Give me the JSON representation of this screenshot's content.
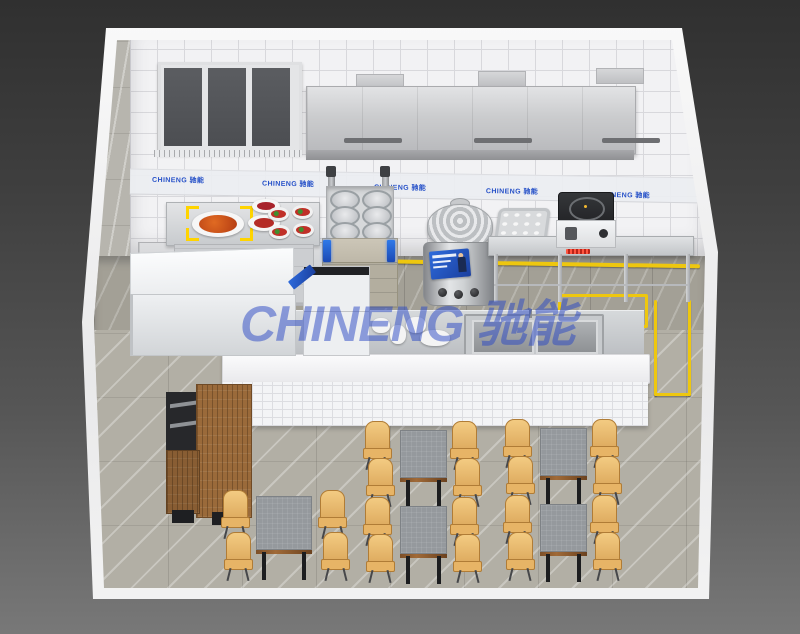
{
  "branding": {
    "watermark": "CHINENG 驰能",
    "wall_logo": "CHINENG 驰能",
    "watermark_color": "#2746c3",
    "logo_blue": "#2550c8"
  },
  "colors": {
    "safety_yellow": "#eec70f",
    "stainless_steel": "#c9ccd0",
    "wall_tile": "#f2f2f4",
    "kitchen_floor": "#a3a096",
    "dining_floor": "#b2afa5",
    "wood_cabinet": "#9a6a3a",
    "chair_wood": "#e7b96f",
    "table_top": "#95999d",
    "background_dark": "#3a3a3a"
  },
  "scene": {
    "description": "3D isometric render of a commercial kitchen with dining area",
    "equipment": [
      "window",
      "exhaust-hood",
      "prep-table-with-dishes",
      "wall-cabinets",
      "double-basket-noodle-cooker",
      "soup-boiler",
      "steam-tray",
      "work-table",
      "induction-cooker",
      "chest-unit",
      "side-cabinet",
      "pass-counter",
      "double-sink",
      "wood-service-station",
      "dining-tables",
      "chairs"
    ],
    "dining_tables": 5,
    "chairs_per_table": 4,
    "wall_logo_positions": [
      {
        "x": 152,
        "y": 5
      },
      {
        "x": 262,
        "y": 7
      },
      {
        "x": 374,
        "y": 9
      },
      {
        "x": 486,
        "y": 11
      },
      {
        "x": 598,
        "y": 13
      }
    ],
    "furniture": {
      "tables": [
        {
          "x": 256,
          "y": 496,
          "w": 56,
          "h": 58,
          "big": true
        },
        {
          "x": 400,
          "y": 430,
          "w": 47,
          "h": 52
        },
        {
          "x": 400,
          "y": 506,
          "w": 47,
          "h": 52
        },
        {
          "x": 540,
          "y": 428,
          "w": 47,
          "h": 52
        },
        {
          "x": 540,
          "y": 504,
          "w": 47,
          "h": 52
        }
      ],
      "chairs": [
        {
          "x": 220,
          "y": 490
        },
        {
          "x": 223,
          "y": 532
        },
        {
          "x": 318,
          "y": 490,
          "flip": true
        },
        {
          "x": 321,
          "y": 532,
          "flip": true
        },
        {
          "x": 362,
          "y": 421
        },
        {
          "x": 365,
          "y": 458
        },
        {
          "x": 450,
          "y": 421,
          "flip": true
        },
        {
          "x": 453,
          "y": 458,
          "flip": true
        },
        {
          "x": 362,
          "y": 497
        },
        {
          "x": 365,
          "y": 534
        },
        {
          "x": 450,
          "y": 497,
          "flip": true
        },
        {
          "x": 453,
          "y": 534,
          "flip": true
        },
        {
          "x": 502,
          "y": 419
        },
        {
          "x": 505,
          "y": 456
        },
        {
          "x": 590,
          "y": 419,
          "flip": true
        },
        {
          "x": 593,
          "y": 456,
          "flip": true
        },
        {
          "x": 502,
          "y": 495
        },
        {
          "x": 505,
          "y": 532
        },
        {
          "x": 590,
          "y": 495,
          "flip": true
        },
        {
          "x": 593,
          "y": 532,
          "flip": true
        }
      ]
    }
  }
}
